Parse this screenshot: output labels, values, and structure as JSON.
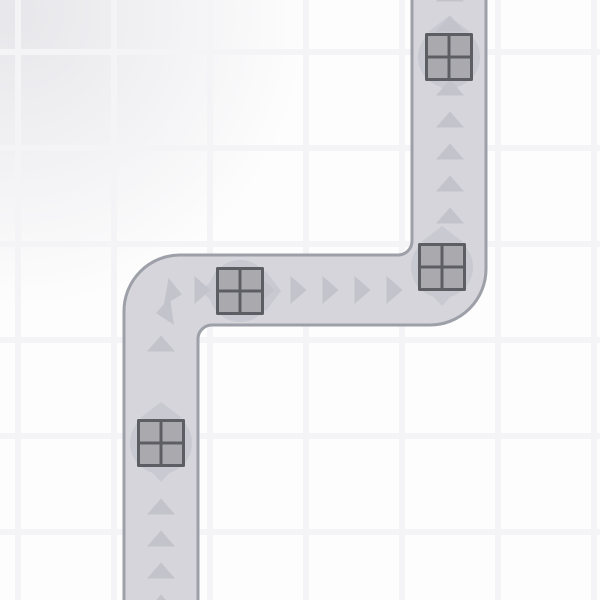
{
  "canvas": {
    "width": 600,
    "height": 600
  },
  "background": {
    "base_color": "#fdfdfd",
    "grid_line_color": "#f4f4f6",
    "grid_spacing": 96,
    "grid_line_width": 6,
    "grid_offset_x": 15,
    "grid_offset_y": 49,
    "vignette_color": "#e7e7eb"
  },
  "road": {
    "fill_color": "#d5d5db",
    "border_color": "#9da0a8",
    "border_width": 3,
    "silhouette_path": "M 124 605 L 124 311 A 56 56 0 0 1 180 255 L 398 255 A 14 14 0 0 0 412 241 L 412 -5 L 486 -5 L 486 269 A 56 56 0 0 1 430 325 L 212 325 A 14 14 0 0 0 198 339 L 198 605 Z"
  },
  "arrows": {
    "color": "#c3c3cb",
    "points_up": "0,-8 14,8 -14,8",
    "items": [
      {
        "x": 450,
        "y": -6.5,
        "rot": 0
      },
      {
        "x": 450,
        "y": 23.5,
        "rot": 0
      },
      {
        "x": 450,
        "y": 55.5,
        "rot": 0
      },
      {
        "x": 450,
        "y": 87.5,
        "rot": 0
      },
      {
        "x": 450,
        "y": 119.5,
        "rot": 0
      },
      {
        "x": 450,
        "y": 151.5,
        "rot": 0
      },
      {
        "x": 450,
        "y": 183.5,
        "rot": 0
      },
      {
        "x": 450,
        "y": 215.5,
        "rot": 0
      },
      {
        "x": 202.5,
        "y": 290,
        "rot": 90
      },
      {
        "x": 234.5,
        "y": 290,
        "rot": 90
      },
      {
        "x": 266.5,
        "y": 290,
        "rot": 90
      },
      {
        "x": 298.5,
        "y": 290,
        "rot": 90
      },
      {
        "x": 330.5,
        "y": 290,
        "rot": 90
      },
      {
        "x": 362.5,
        "y": 290,
        "rot": 90
      },
      {
        "x": 394.5,
        "y": 290,
        "rot": 90
      },
      {
        "x": 174,
        "y": 293,
        "rot": 100
      },
      {
        "x": 164,
        "y": 312,
        "rot": 262
      },
      {
        "x": 161,
        "y": 343.5,
        "rot": 0
      },
      {
        "x": 161,
        "y": 506.5,
        "rot": 0
      },
      {
        "x": 161,
        "y": 538.5,
        "rot": 0
      },
      {
        "x": 161,
        "y": 570.5,
        "rot": 0
      },
      {
        "x": 161,
        "y": 602.5,
        "rot": 0
      }
    ]
  },
  "crates": {
    "size": 48,
    "frame_color": "#5d5d64",
    "pane_color": "#aaaaae",
    "frame_thickness": 3,
    "divider_thickness": 3,
    "backdrop_color": "#c9c9d1",
    "backdrop_circle_radius": 31,
    "backdrop_apex_points": "0,-41 21,-25 -21,-25",
    "backdrop_tail_points": "0,39 13,25 -13,25",
    "items": [
      {
        "x": 449,
        "y": 57,
        "rot": 0
      },
      {
        "x": 442,
        "y": 267,
        "rot": 0
      },
      {
        "x": 240,
        "y": 291,
        "rot": 90
      },
      {
        "x": 161,
        "y": 443,
        "rot": 0
      }
    ]
  }
}
